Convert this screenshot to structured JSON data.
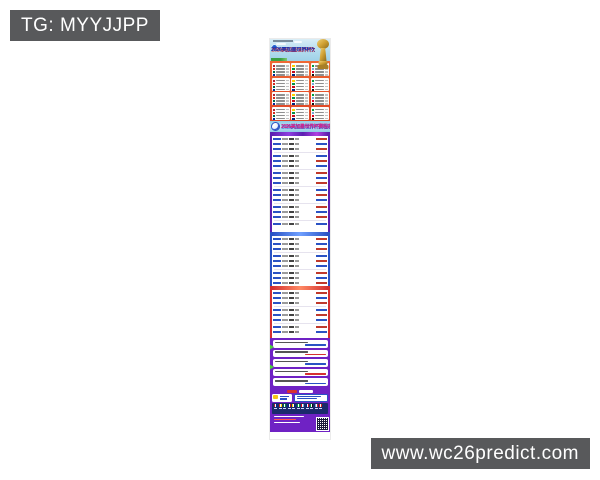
{
  "watermarks": {
    "tg_label": "TG: MYYJJPP",
    "site_label": "www.wc26predict.com",
    "bg_color": "#58595b",
    "text_color": "#ffffff"
  },
  "poster": {
    "groups_title": "2026美加墨世界杯分组",
    "schedule_title": "2026美加墨世界杯赛程表",
    "colors": {
      "sky": "#b3dcee",
      "groups_bg": "#e4502a",
      "banner_bg": "#8ecbe6",
      "table1_border": "#5b1fb0",
      "table2_border": "#2a52c4",
      "table3_border": "#d32f2f",
      "footer_bg": "#6f22c4",
      "flags_panel": "#1b2a6b",
      "trophy_gold": "#d4a93f"
    }
  }
}
